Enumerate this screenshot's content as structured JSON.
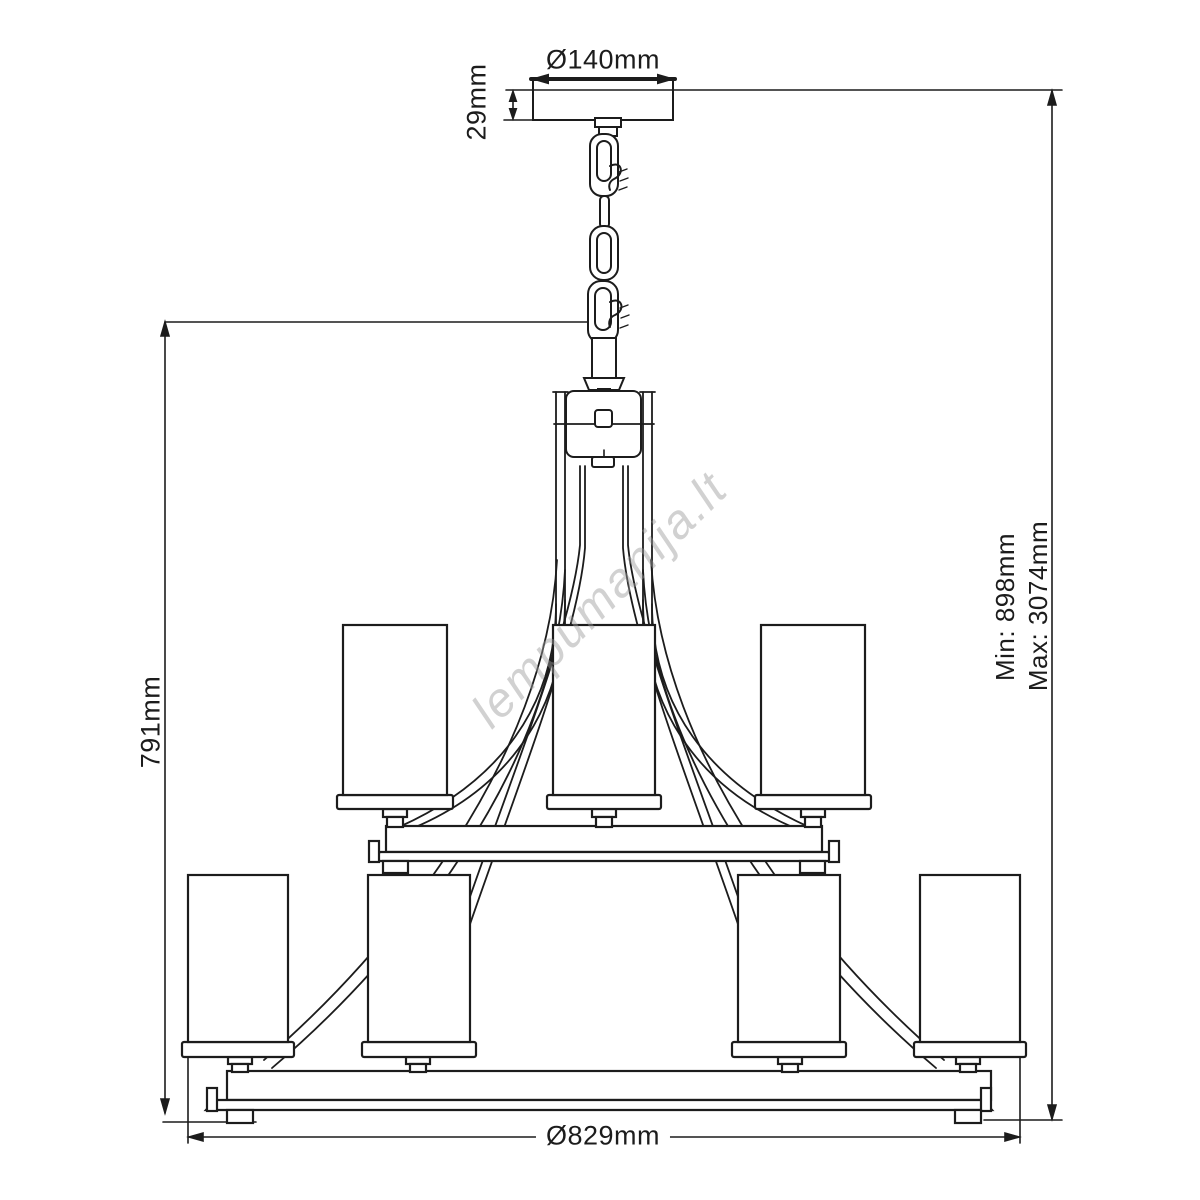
{
  "page": {
    "background": "#ffffff"
  },
  "drawing": {
    "type": "technical-dimension-diagram",
    "subject": "two-tier chandelier with cylindrical shades hanging on a chain from a ceiling canopy",
    "line_color": "#1c1c1c",
    "upper_tier_shades": 3,
    "lower_tier_shades": 4
  },
  "dimensions": {
    "canopy_diameter": "Ø140mm",
    "canopy_height": "29mm",
    "body_height": "791mm",
    "suspension_min": "Min: 898mm",
    "suspension_max": "Max: 3074mm",
    "fixture_diameter": "Ø829mm"
  },
  "watermark": {
    "text": "lempumanija.lt",
    "color": "#9a9a9a"
  }
}
